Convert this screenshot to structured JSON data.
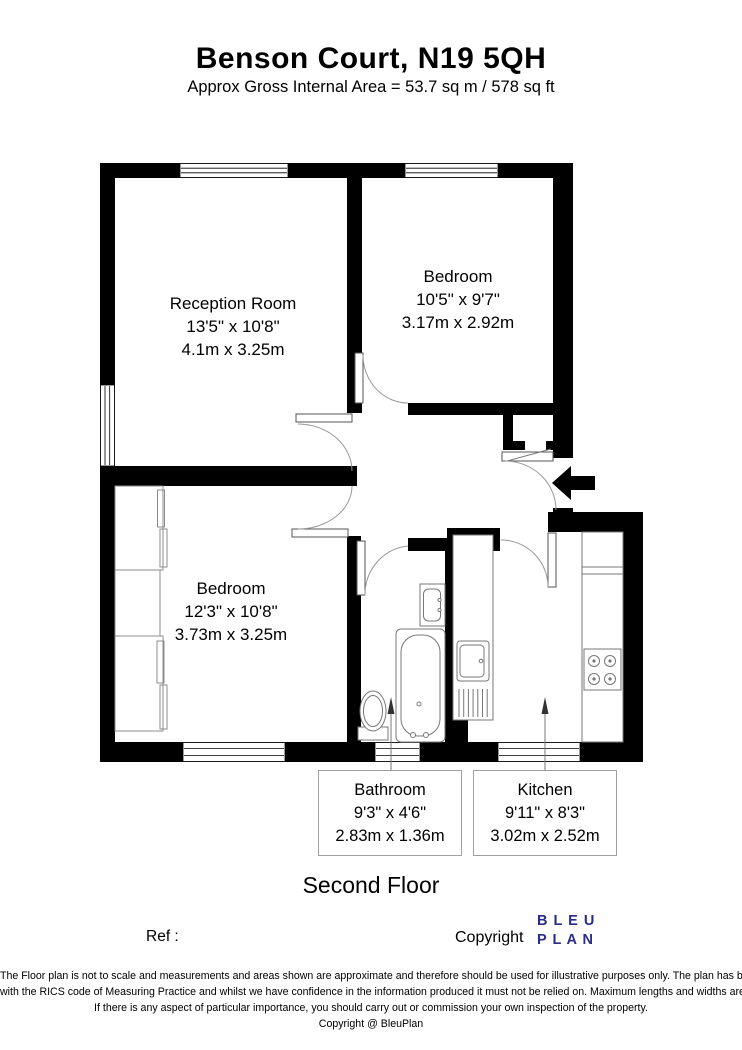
{
  "header": {
    "title": "Benson Court, N19 5QH",
    "subtitle": "Approx Gross Internal Area = 53.7 sq m / 578 sq ft"
  },
  "rooms": {
    "reception": {
      "name": "Reception Room",
      "imperial": "13'5\" x 10'8\"",
      "metric": "4.1m x 3.25m"
    },
    "bedroom1": {
      "name": "Bedroom",
      "imperial": "10'5\" x 9'7\"",
      "metric": "3.17m x 2.92m"
    },
    "bedroom2": {
      "name": "Bedroom",
      "imperial": "12'3\" x 10'8\"",
      "metric": "3.73m x 3.25m"
    },
    "bathroom": {
      "name": "Bathroom",
      "imperial": "9'3\" x 4'6\"",
      "metric": "2.83m x 1.36m"
    },
    "kitchen": {
      "name": "Kitchen",
      "imperial": "9'11\" x 8'3\"",
      "metric": "3.02m x 2.52m"
    }
  },
  "floor_label": "Second Floor",
  "footer": {
    "ref_label": "Ref  :",
    "copyright_label": "Copyright",
    "logo_line1": "B L E U",
    "logo_line2": "P L A N"
  },
  "disclaimer": {
    "line1": "The Floor plan is not to scale and measurements and areas shown are approximate and therefore should be used for illustrative purposes only. The plan has been prepared in accordance",
    "line2": "with the RICS code of Measuring Practice and whilst we have confidence in the information produced it must not be relied on. Maximum lengths and widths are represented on the floor plan.",
    "line3": "If there is any aspect of particular importance, you should carry out or commission your own inspection of the property.",
    "line4": "Copyright @ BleuPlan"
  },
  "colors": {
    "walls": "#000000",
    "logo": "#2b2c86",
    "fixture_lines": "#777777"
  }
}
